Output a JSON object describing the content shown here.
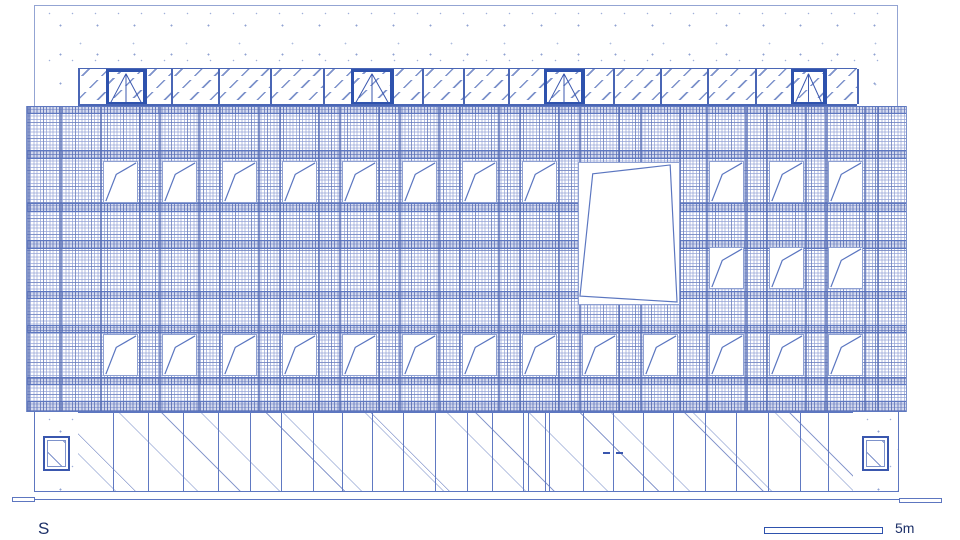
{
  "labels": {
    "orientation": "S",
    "scale": "5m"
  },
  "colors": {
    "line_light": "#b6c2e3",
    "line_soft": "#7d92cb",
    "line_mid": "#5d76c0",
    "line_strong": "#3a57ae",
    "line_dark": "#2e52ad",
    "text": "#1d3068",
    "background": "#ffffff"
  },
  "elevation": {
    "shell": {
      "x": 34,
      "y": 5,
      "w": 864,
      "h": 101
    },
    "roof": {
      "x": 78,
      "y": 68,
      "w": 779,
      "h": 38,
      "dividers": [
        78,
        107,
        145,
        171,
        218,
        270,
        323,
        352,
        392,
        422,
        463,
        508,
        545,
        583,
        613,
        660,
        707,
        755,
        792,
        825,
        857
      ],
      "doors": [
        [
          107,
          145
        ],
        [
          352,
          392
        ],
        [
          545,
          583
        ],
        [
          792,
          825
        ]
      ]
    },
    "mesh": {
      "x": 26,
      "y": 106,
      "w": 881,
      "h": 306
    },
    "bands": [
      {
        "y": 106,
        "h": 8
      },
      {
        "y": 150,
        "h": 9
      },
      {
        "y": 203,
        "h": 9
      },
      {
        "y": 240,
        "h": 9
      },
      {
        "y": 291,
        "h": 8
      },
      {
        "y": 325,
        "h": 8
      },
      {
        "y": 377,
        "h": 8
      },
      {
        "y": 401,
        "h": 11
      }
    ],
    "window": {
      "w": 35,
      "h": 42,
      "flap_points": "2,41 13,13 34,1"
    },
    "rows": [
      {
        "y": 161,
        "cols": [
          103,
          162,
          222,
          282,
          342,
          402,
          462,
          522,
          709,
          769,
          828
        ]
      },
      {
        "y": 247,
        "cols": [
          709,
          769,
          828
        ]
      },
      {
        "y": 334,
        "cols": [
          103,
          162,
          222,
          282,
          342,
          402,
          462,
          522,
          582,
          643,
          709,
          769,
          828
        ]
      }
    ],
    "heavy_cols_extra": [
      28,
      60,
      877
    ],
    "opening": {
      "x": 578,
      "y": 162,
      "w": 102,
      "h": 143,
      "flap_polygon": "14,11 93,2 100,141 1,135"
    },
    "ground": {
      "y": 412,
      "h": 79,
      "left_wall": {
        "x": 34,
        "w": 44
      },
      "right_wall": {
        "x": 853,
        "w": 46
      },
      "glazing": {
        "x": 78,
        "w": 775,
        "mullions": [
          113,
          148,
          183,
          218,
          250,
          281,
          313,
          342,
          372,
          403,
          435,
          467,
          492,
          523,
          528,
          545,
          549,
          583,
          643,
          673,
          705,
          736,
          768,
          800,
          828
        ]
      },
      "door": {
        "center": 613,
        "handle_y": 452
      },
      "steps": {
        "x": 465,
        "w": 208,
        "lines_y": [
          494,
          497
        ]
      },
      "small_windows": [
        {
          "x": 43,
          "y": 436,
          "w": 27,
          "h": 35
        },
        {
          "x": 862,
          "y": 436,
          "w": 27,
          "h": 35
        }
      ]
    },
    "plinth": {
      "x": 34,
      "y": 491,
      "w": 865,
      "h": 9
    },
    "plinth_steps": [
      {
        "x": 12,
        "y": 497,
        "w": 23,
        "h": 5
      },
      {
        "x": 899,
        "y": 498,
        "w": 43,
        "h": 5
      }
    ],
    "scalebar": {
      "x": 764,
      "y": 527,
      "w": 119,
      "h": 7
    }
  }
}
